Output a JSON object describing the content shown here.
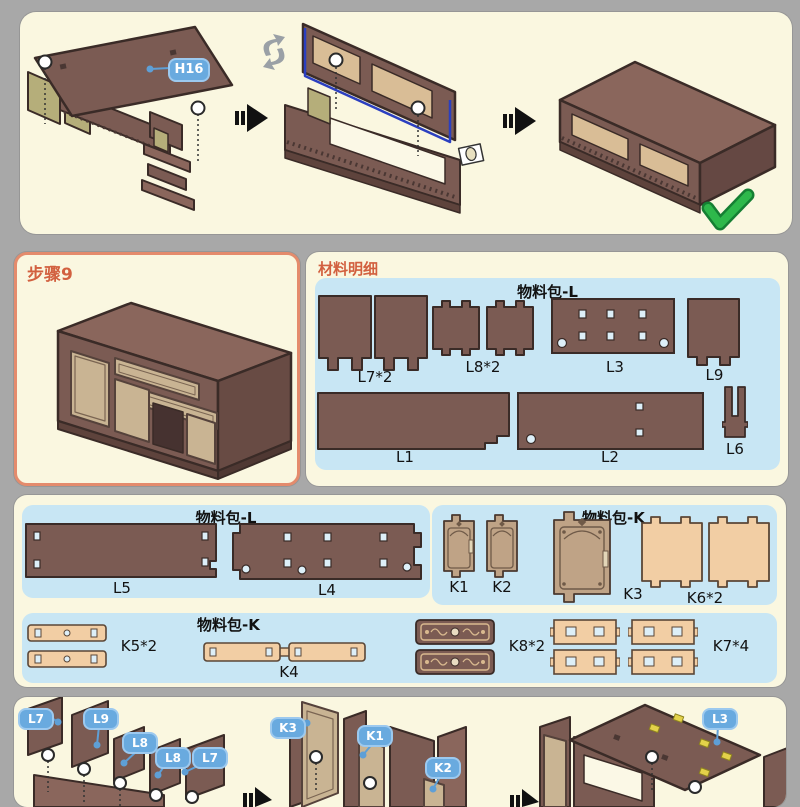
{
  "colors": {
    "page_bg": "#A8A8A8",
    "panel_bg": "#FAF7E0",
    "blue_panel": "#C8E6F4",
    "badge_blue": "#69AADF",
    "accent_red": "#D2603F",
    "step_border": "#E48B6C",
    "wood_brown": "#7B5B53",
    "wood_tan": "#F2CEA4",
    "door_tan": "#BFA386",
    "check_green": "#2EB84B",
    "highlight_blue_line": "#2B3FC0",
    "highlight_yellow": "#E3D24A"
  },
  "top_steps": {
    "h16_badge": "H16"
  },
  "step_panel": {
    "title": "步骤9"
  },
  "materials": {
    "title": "材料明细",
    "pack": {
      "title": "物料包-L",
      "l7": "L7*2",
      "l8": "L8*2",
      "l3": "L3",
      "l9": "L9",
      "l1": "L1",
      "l2": "L2",
      "l6": "L6"
    }
  },
  "packs": {
    "pack_l": {
      "title": "物料包-L",
      "l5": "L5",
      "l4": "L4"
    },
    "pack_k_top": {
      "title": "物料包-K",
      "k1": "K1",
      "k2": "K2",
      "k3": "K3",
      "k6": "K6*2"
    },
    "pack_k_bottom": {
      "title": "物料包-K",
      "k5": "K5*2",
      "k4": "K4",
      "k8": "K8*2",
      "k7": "K7*4"
    }
  },
  "assembly_badges": [
    {
      "label": "L7"
    },
    {
      "label": "L9"
    },
    {
      "label": "L8"
    },
    {
      "label": "L8"
    },
    {
      "label": "L7"
    },
    {
      "label": "K3"
    },
    {
      "label": "K1"
    },
    {
      "label": "K2"
    },
    {
      "label": "L3"
    }
  ]
}
